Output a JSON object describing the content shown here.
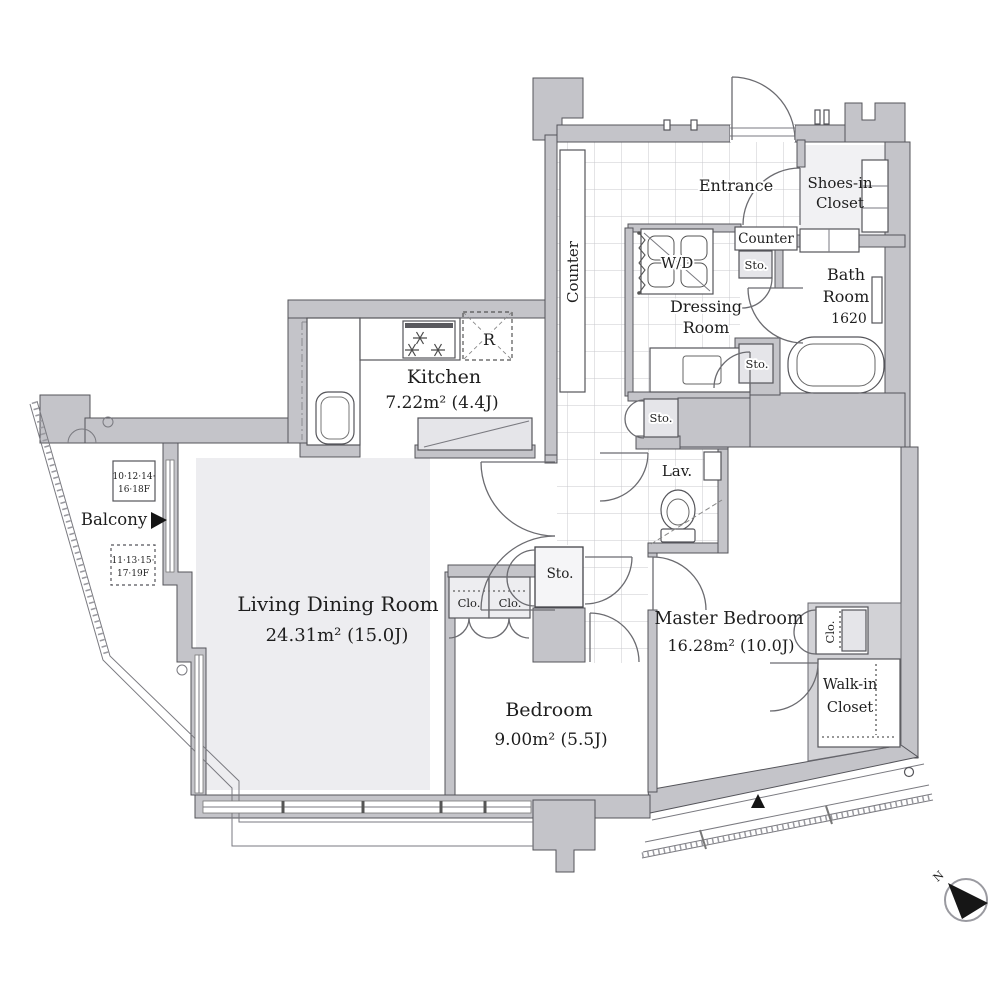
{
  "plan": {
    "rooms": {
      "living": {
        "name": "Living Dining Room",
        "area": "24.31m²  (15.0J)"
      },
      "kitchen": {
        "name": "Kitchen",
        "area": "7.22m²  (4.4J)"
      },
      "bedroom": {
        "name": "Bedroom",
        "area": "9.00m²  (5.5J)"
      },
      "master": {
        "name": "Master Bedroom",
        "area": "16.28m²  (10.0J)"
      },
      "entrance": {
        "name": "Entrance"
      },
      "dressing": {
        "line1": "Dressing",
        "line2": "Room"
      },
      "bath": {
        "line1": "Bath",
        "line2": "Room",
        "size": "1620"
      },
      "lav": {
        "name": "Lav."
      },
      "balcony": {
        "name": "Balcony"
      },
      "walkin": {
        "line1": "Walk-in",
        "line2": "Closet"
      },
      "shoes": {
        "line1": "Shoes-in",
        "line2": "Closet"
      }
    },
    "labels": {
      "counter_corridor": "Counter",
      "counter_entrance": "Counter",
      "wd": "W/D",
      "sto": "Sto.",
      "clo": "Clo.",
      "fridge": "R",
      "north": "N"
    },
    "floor_boxes": {
      "solid": {
        "line1": "10·12·14·",
        "line2": "16·18F"
      },
      "dashed": {
        "line1": "11·13·15·",
        "line2": "17·19F"
      }
    }
  }
}
